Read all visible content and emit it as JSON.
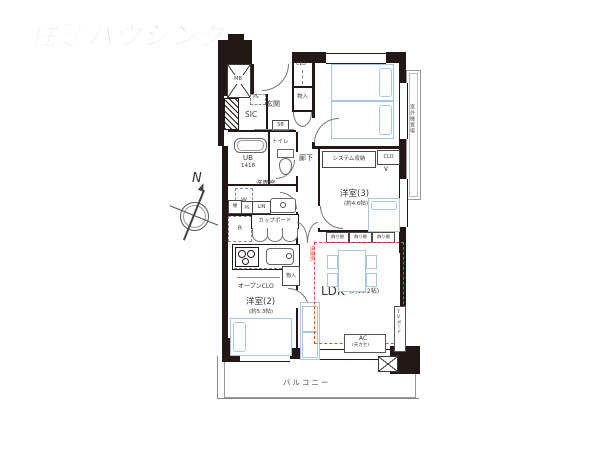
{
  "logo": {
    "text": "住建ハウジング"
  },
  "compass": {
    "north": "N"
  },
  "rooms": {
    "y1": {
      "name": "洋室(1)",
      "size": "(約6.7帖)"
    },
    "y2": {
      "name": "洋室(2)",
      "size": "(約5.3帖)"
    },
    "y3": {
      "name": "洋室(3)",
      "size": "(約4.6帖)"
    },
    "ldk": {
      "name": "LDK",
      "size": "(約16.2帖)"
    }
  },
  "labels": {
    "genkan": "玄関",
    "sic": "SIC",
    "sb": "SB",
    "toilet": "トイレ",
    "ub": "UB",
    "ub_size": "1418",
    "rouka": "廊下",
    "senmen": "洗面室",
    "cupboard": "カップボード",
    "system": "システム収納",
    "clo": "CLO",
    "monoire": "物入",
    "open_clo": "オープンCLO",
    "kazaridana": "飾り棚",
    "yukadan": "床暖房",
    "ac": "AC",
    "ac_sub": "(天カセ)",
    "tv": "TVボード",
    "outdoor": "室外機置場",
    "balcony": "バルコニー",
    "mb": "MB",
    "ps": "PS",
    "w": "W",
    "r": "R",
    "tana": "棚",
    "lin": "LIN",
    "hanger": "∨"
  },
  "colors": {
    "wall": "#231815",
    "furniture": "#a9c7e2",
    "floor_heating": "#e0503c",
    "logo": "#c9dcf5"
  }
}
